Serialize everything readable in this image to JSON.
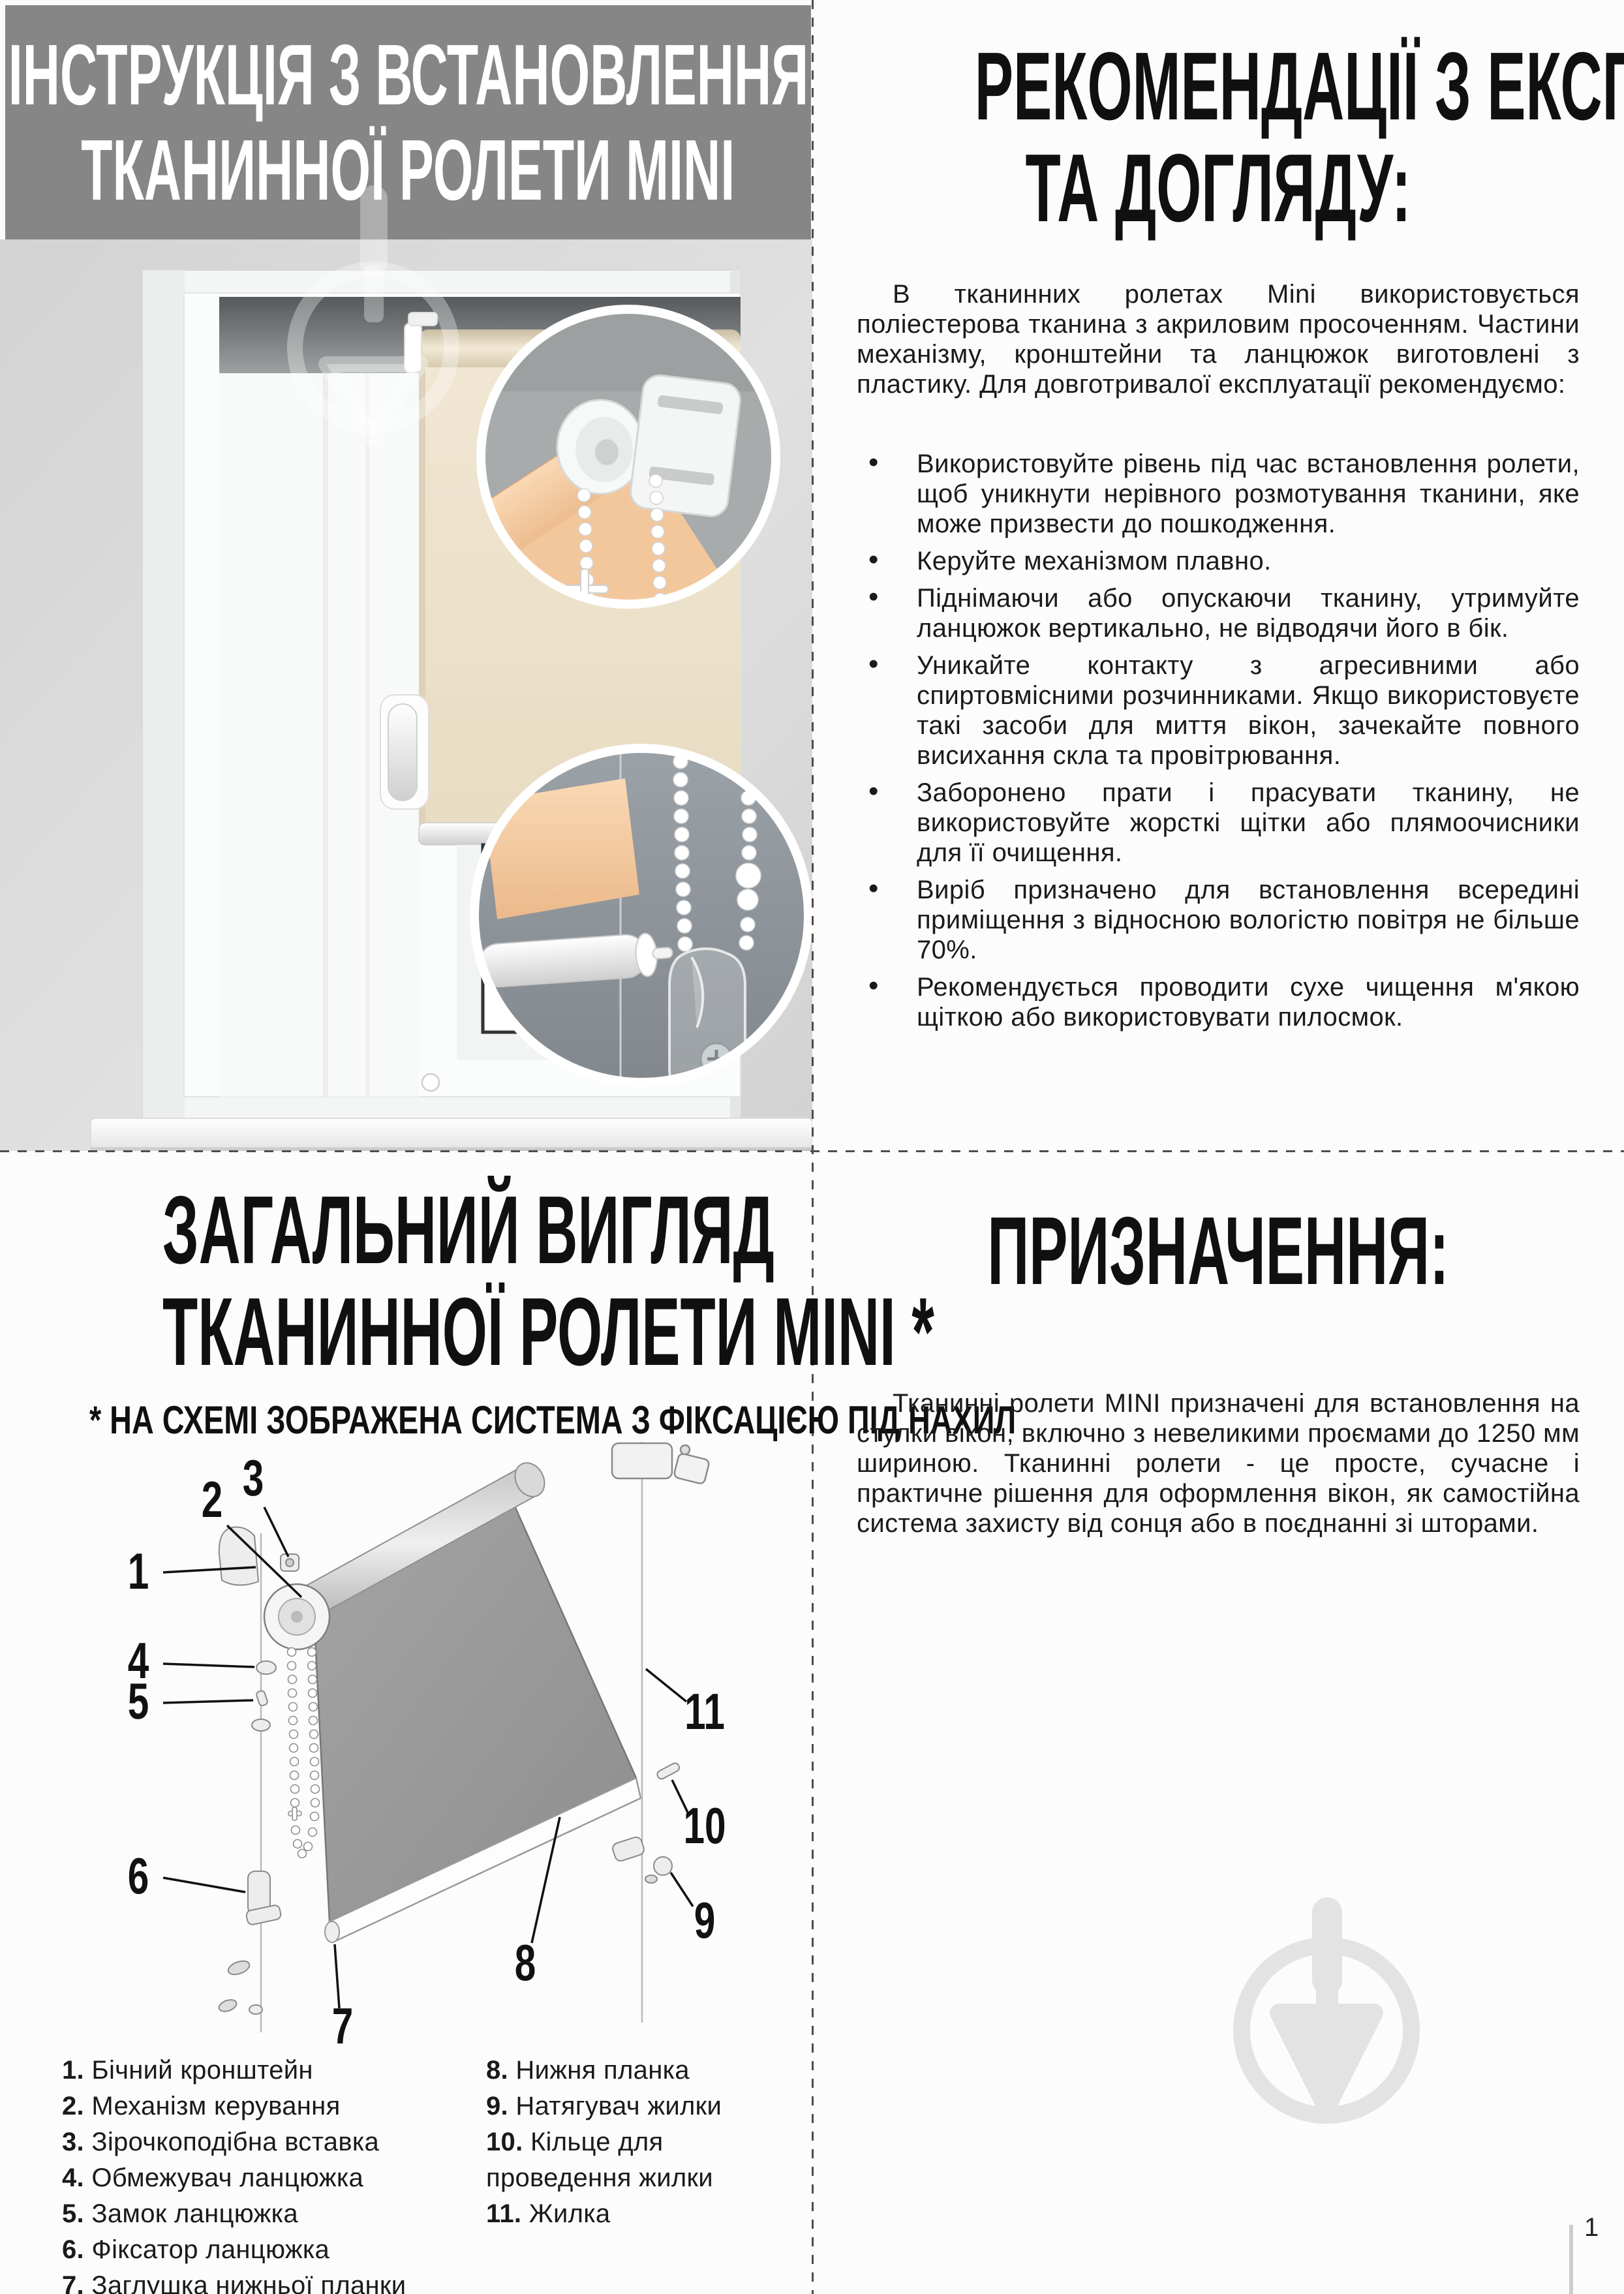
{
  "header": {
    "title_line1": "ІНСТРУКЦІЯ З ВСТАНОВЛЕННЯ",
    "title_line2": "ТКАНИННОЇ РОЛЕТИ MINI"
  },
  "care": {
    "title_line1": "РЕКОМЕНДАЦІЇ З ЕКСПЛУАТАЦІЇ",
    "title_line2": "ТА ДОГЛЯДУ:",
    "intro": "В тканинних ролетах Mini використовується поліестерова тканина з акриловим просоченням. Частини механізму, кронштейни та ланцюжок виготовлені з пластику. Для довготривалої експлуатації рекомендуємо:",
    "bullets": [
      "Використовуйте рівень під час встановлення ролети, щоб уникнути нерівного розмотування тканини, яке може призвести до пошкодження.",
      "Керуйте механізмом плавно.",
      "Піднімаючи або опускаючи тканину, утримуйте ланцюжок вертикально, не відводячи його в бік.",
      "Уникайте контакту з агресивними або спиртовмісними розчинниками. Якщо використовуєте такі засоби для миття вікон, зачекайте повного висихання скла та провітрювання.",
      "Заборонено прати і прасувати тканину, не використовуйте жорсткі щітки або плямоочисники для її очищення.",
      "Виріб призначено для встановлення всередині приміщення з відносною вологістю повітря не більше 70%.",
      "Рекомендується проводити сухе чищення м'якою щіткою або використовувати пилосмок."
    ],
    "bullet_char": "•"
  },
  "overview": {
    "title_line1": "ЗАГАЛЬНИЙ ВИГЛЯД",
    "title_line2": "ТКАНИННОЇ РОЛЕТИ MINI *",
    "subtitle": "* НА СХЕМІ ЗОБРАЖЕНА СИСТЕМА З ФІКСАЦІЄЮ ПІД НАХИЛ",
    "callouts": [
      "1",
      "2",
      "3",
      "4",
      "5",
      "6",
      "7",
      "8",
      "9",
      "10",
      "11"
    ],
    "legend_left": [
      {
        "num": "1.",
        "label": "Бічний кронштейн"
      },
      {
        "num": "2.",
        "label": "Механізм керування"
      },
      {
        "num": "3.",
        "label": "Зірочкоподібна вставка"
      },
      {
        "num": "4.",
        "label": "Обмежувач ланцюжка"
      },
      {
        "num": "5.",
        "label": "Замок ланцюжка"
      },
      {
        "num": "6.",
        "label": "Фіксатор ланцюжка"
      },
      {
        "num": "7.",
        "label": "Заглушка нижньої планки"
      }
    ],
    "legend_right": [
      {
        "num": "8.",
        "label": "Нижня планка"
      },
      {
        "num": "9.",
        "label": "Натягувач жилки"
      },
      {
        "num": "10.",
        "label": "Кільце для проведення жилки"
      },
      {
        "num": "11.",
        "label": "Жилка"
      }
    ]
  },
  "purpose": {
    "title": "ПРИЗНАЧЕННЯ:",
    "body": "Тканинні ролети MINI призначені для встановлення на стулки вікон, включно з невеликими проємами до 1250 мм шириною. Тканинні ролети - це просте, сучасне і практичне рішення для оформлення вікон, як самостійна система захисту від сонця або в поєднанні зі шторами."
  },
  "page": {
    "number": "1"
  },
  "colors": {
    "header_bg": "#868686",
    "fabric_beige": "#eee3cd",
    "fabric_peach": "#f5cba2",
    "watermark_gray": "#e3e3e3",
    "diagram_gray": "#9b9b9b"
  }
}
